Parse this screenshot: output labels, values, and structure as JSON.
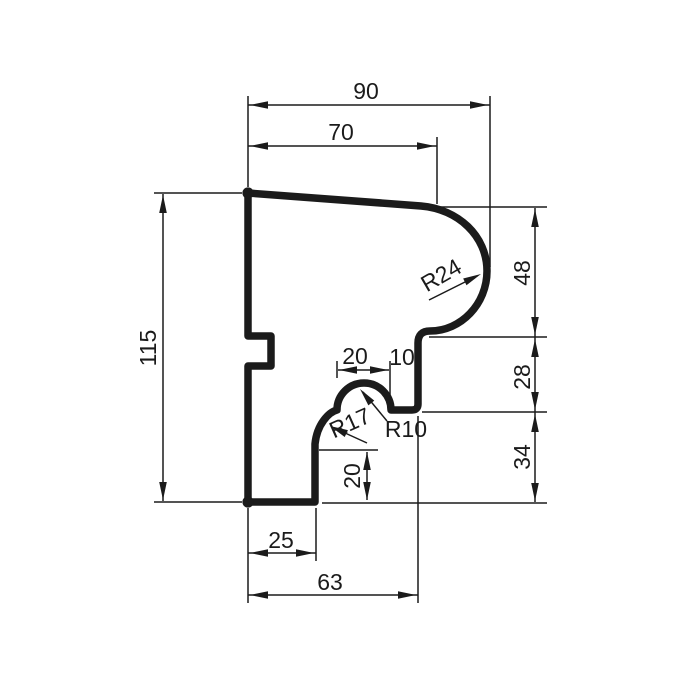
{
  "drawing": {
    "type": "2d-profile-section",
    "colors": {
      "ink": "#1b1b1b",
      "background": "#ffffff"
    },
    "dims": {
      "total_width": "90",
      "top_width": "70",
      "total_height": "115",
      "right_upper_height": "48",
      "right_middle_height": "28",
      "right_lower_height": "34",
      "bead_width": "20",
      "bead_offset": "10",
      "step_height": "20",
      "bottom_left_width": "25",
      "bottom_width": "63"
    },
    "radii": {
      "top_bullnose": "R24",
      "cove": "R17",
      "bead": "R10"
    }
  }
}
